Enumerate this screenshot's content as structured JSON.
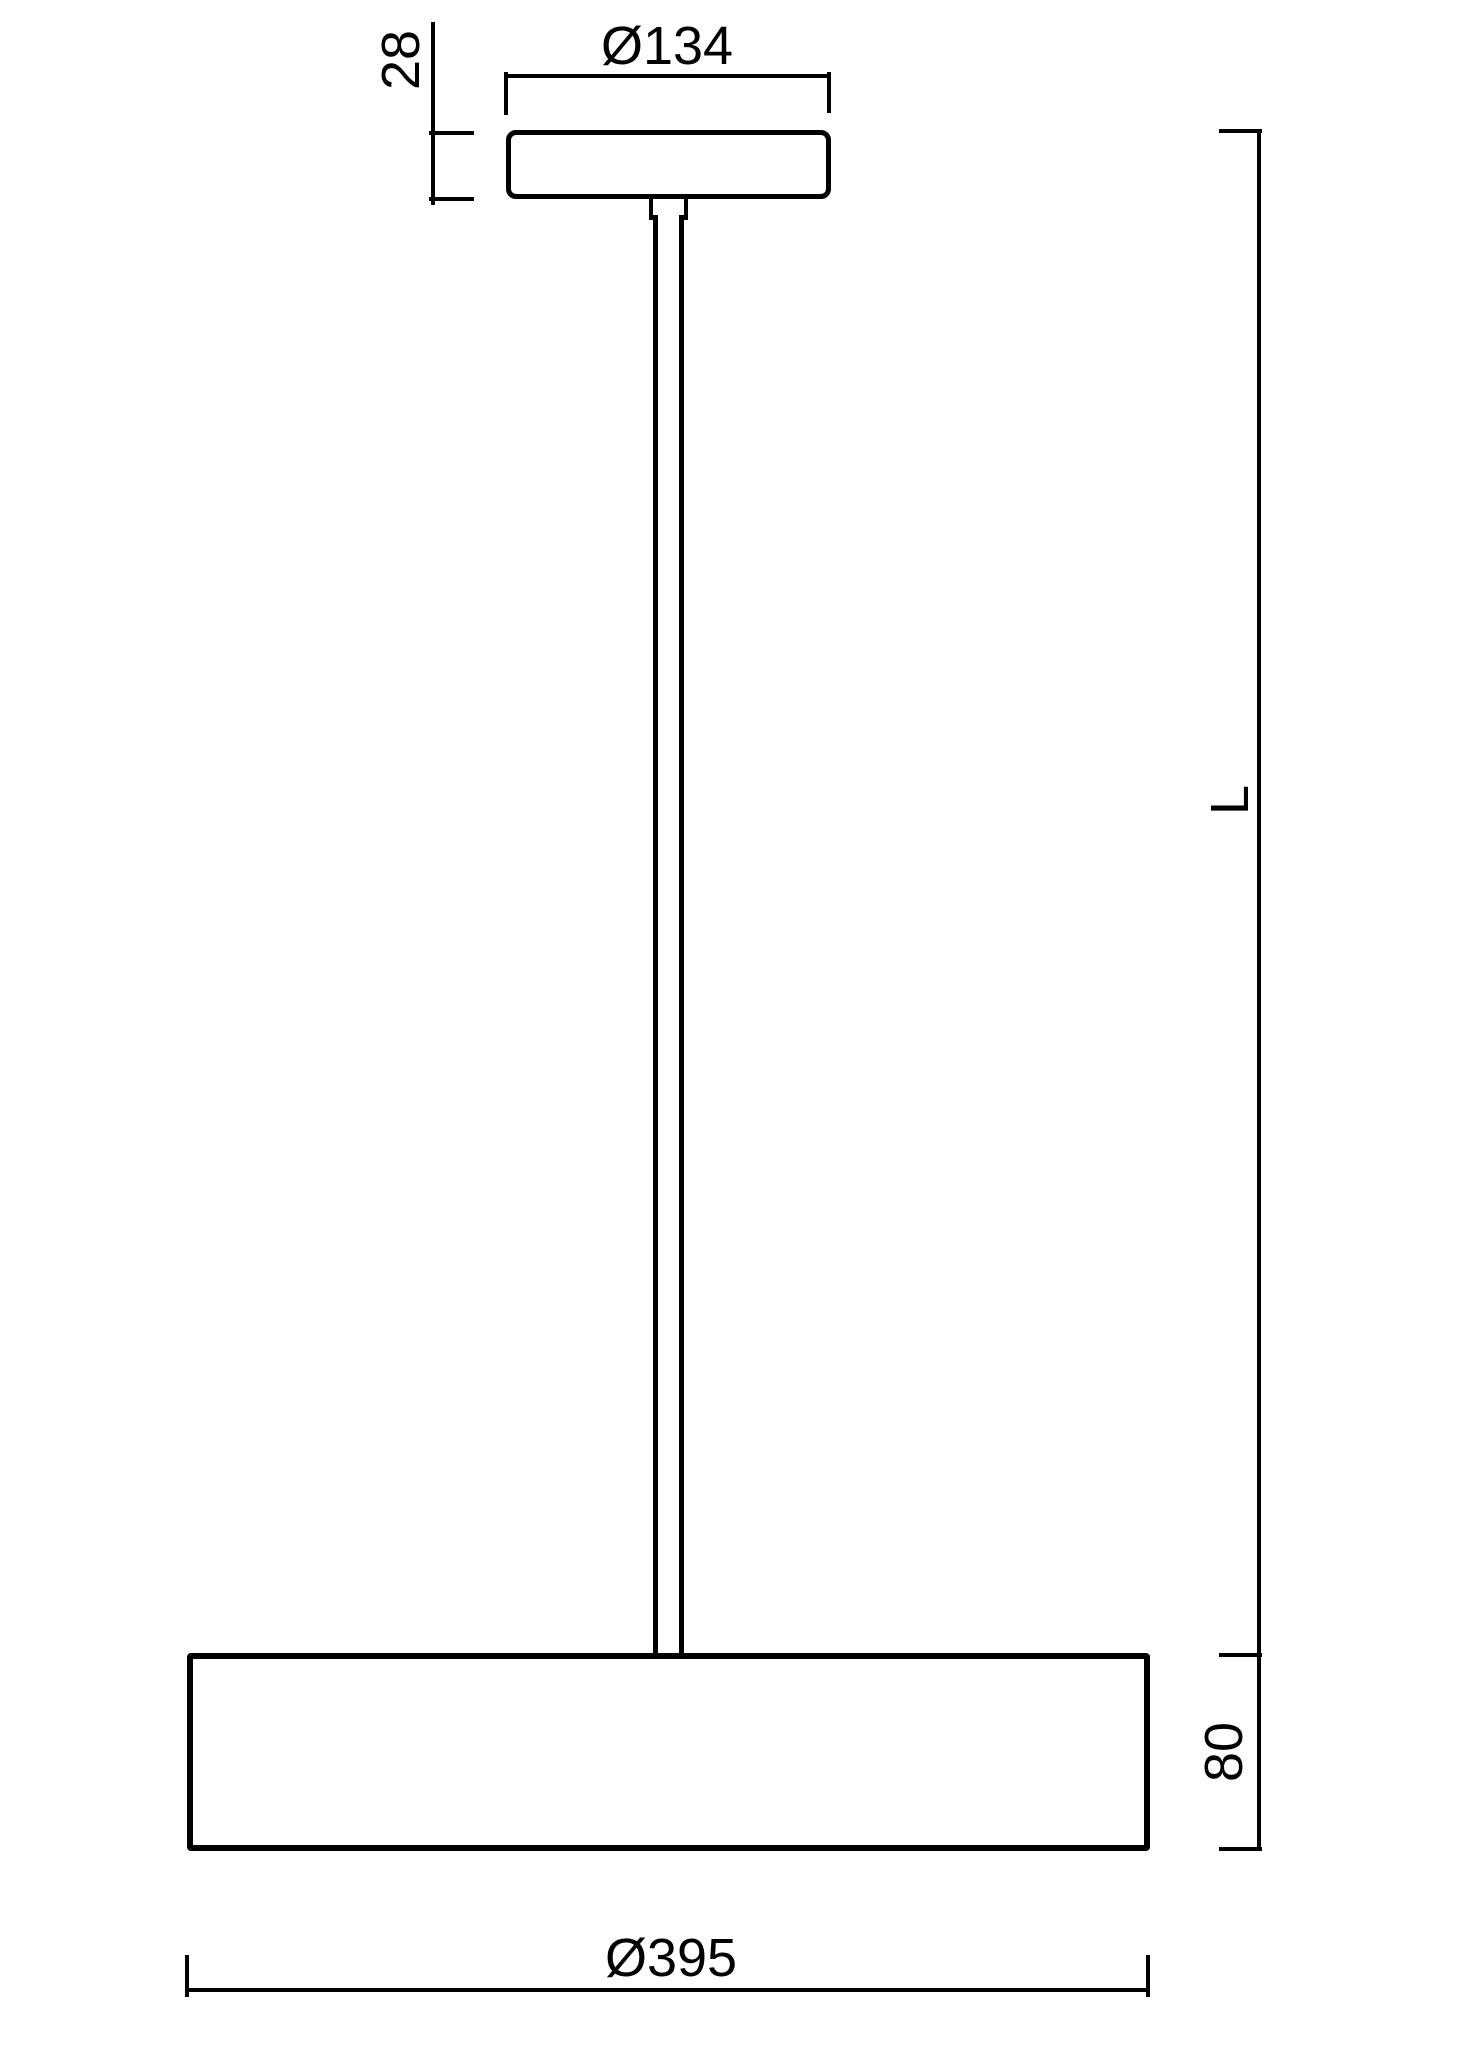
{
  "canvas": {
    "background": "#ffffff",
    "line_color": "#000000"
  },
  "dimensions": {
    "canopy_height": {
      "label": "28",
      "orientation": "vertical"
    },
    "canopy_diameter": {
      "label": "Ø134",
      "orientation": "horizontal"
    },
    "overall_length": {
      "label": "L",
      "orientation": "vertical"
    },
    "shade_height": {
      "label": "80",
      "orientation": "vertical"
    },
    "shade_diameter": {
      "label": "Ø395",
      "orientation": "horizontal"
    }
  }
}
